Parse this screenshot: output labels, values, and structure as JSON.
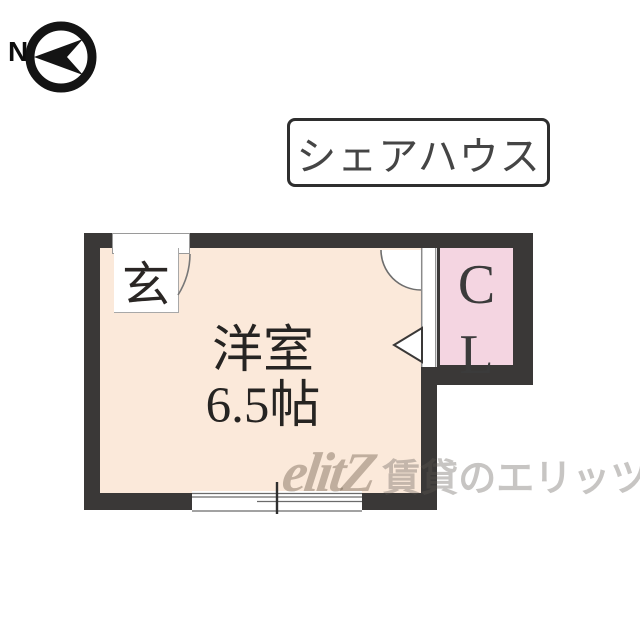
{
  "compass": {
    "label": "N"
  },
  "badge": {
    "label": "シェアハウス"
  },
  "floor_plan": {
    "entrance": {
      "label": "玄"
    },
    "room": {
      "name": "洋室",
      "size": "6.5帖"
    },
    "closet": {
      "letters": [
        "C",
        "L"
      ]
    }
  },
  "watermark": {
    "logo": "elitZ",
    "text": "賃貸のエリッツ"
  },
  "colors": {
    "wall": "#3a3837",
    "room_floor": "#fbe9da",
    "closet_floor": "#f4d5e1",
    "line": "#6b6b6b"
  }
}
